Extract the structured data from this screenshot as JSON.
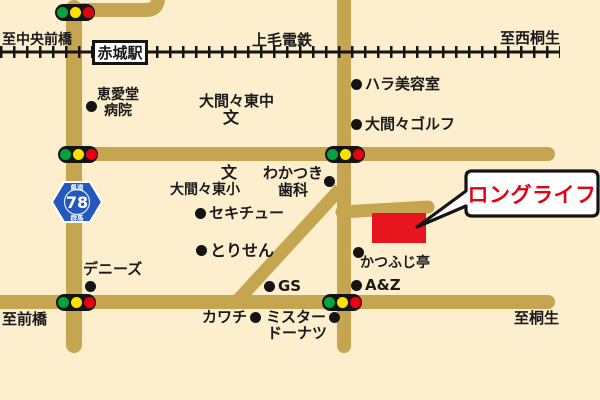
{
  "colors": {
    "background": "#fdeecd",
    "road": "#c6a551",
    "ink": "#1a1a1a",
    "building_red": "#e8141e",
    "text_red": "#e60012",
    "signal_green": "#00a33e",
    "signal_yellow": "#ffe100",
    "signal_red": "#e60012",
    "route_blue": "#2558bd"
  },
  "railway": {
    "name": "上毛電鉄",
    "station": "赤城駅"
  },
  "directions": {
    "west": "至中央前橋",
    "east": "至西桐生",
    "southwest": "至前橋",
    "southeast": "至桐生"
  },
  "route_sign": {
    "top": "県道",
    "number": "78",
    "bottom": "群馬"
  },
  "callout": {
    "label": "ロングライフ"
  },
  "landmarks": {
    "hospital_line1": "恵愛堂",
    "hospital_line2": "病院",
    "junior_high": "大間々東中",
    "junior_high_symbol": "文",
    "beauty_salon": "ハラ美容室",
    "golf": "大間々ゴルフ",
    "elementary_symbol": "文",
    "elementary": "大間々東小",
    "dental_line1": "わかつき",
    "dental_line2": "歯科",
    "sekichu": "セキチュー",
    "torisen": "とりせん",
    "dennys": "デニーズ",
    "katsufuji": "かつふじ亭",
    "gs": "GS",
    "az": "A&Z",
    "kawachi": "カワチ",
    "mister_line1": "ミスター",
    "mister_line2": "ドーナツ"
  }
}
